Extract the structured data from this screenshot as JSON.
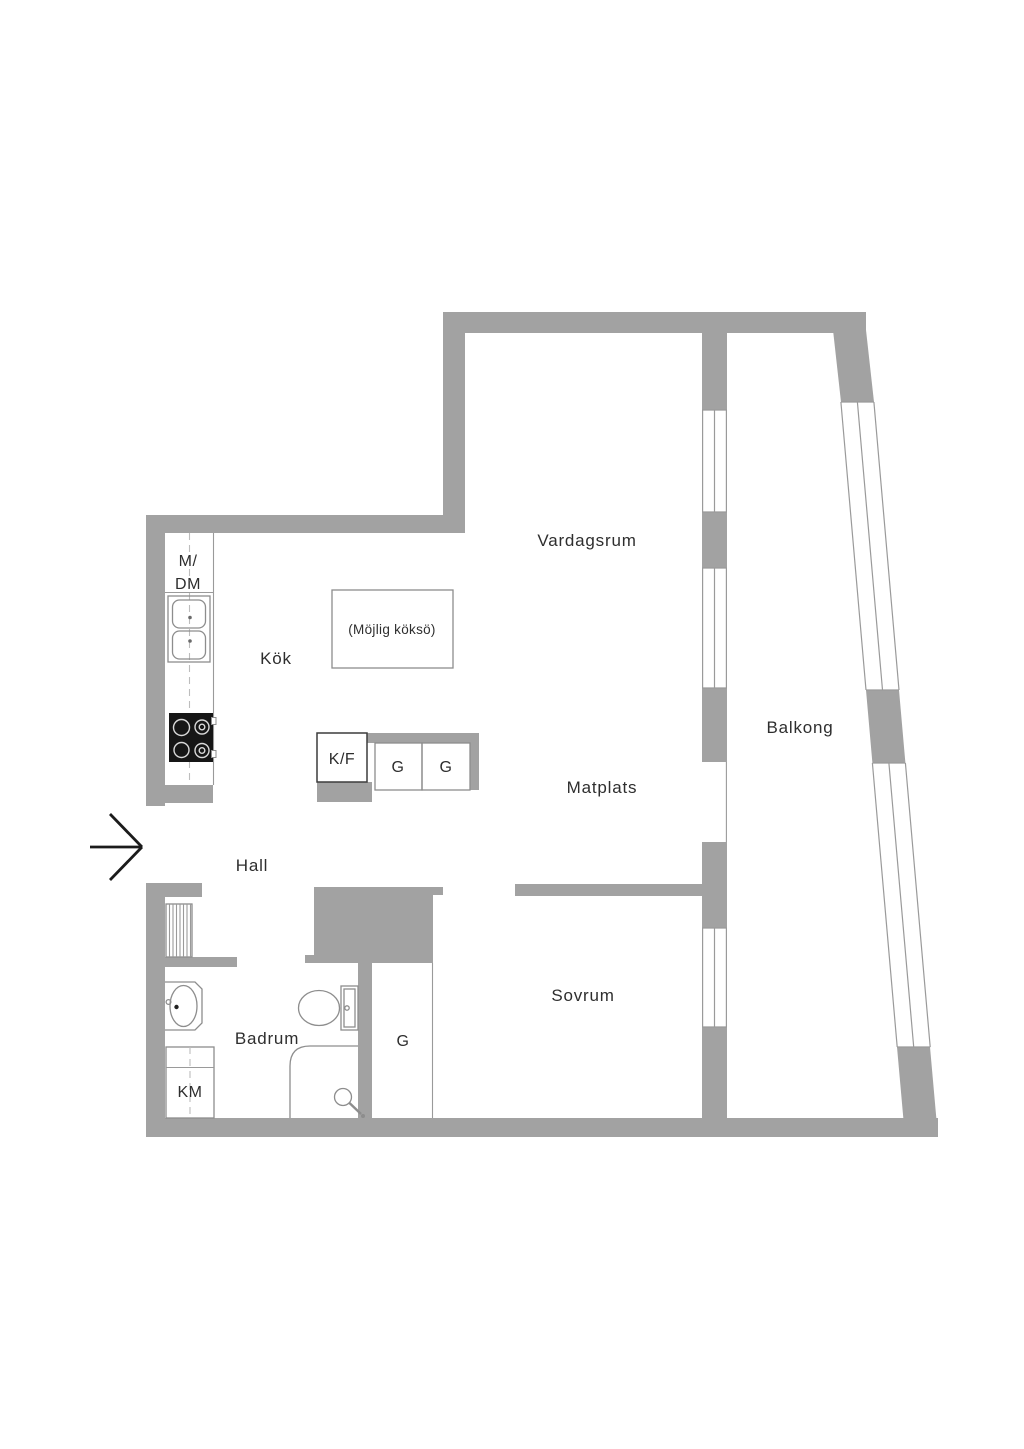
{
  "plan": {
    "rooms": {
      "vardagsrum": "Vardagsrum",
      "balkong": "Balkong",
      "kok": "Kök",
      "matplats": "Matplats",
      "hall": "Hall",
      "badrum": "Badrum",
      "sovrum": "Sovrum"
    },
    "appliances": {
      "m_dm_line1": "M/",
      "m_dm_line2": "DM",
      "kf": "K/F",
      "g1": "G",
      "g2": "G",
      "g_closet": "G",
      "km": "KM",
      "island_note": "(Möjlig köksö)"
    },
    "colors": {
      "wall": "#a2a2a2",
      "winline": "#9a9a9a",
      "fixline": "#8d8d8d",
      "dashline": "#bdbdbd",
      "text": "#2e2e2e",
      "stove": "#161616",
      "arrow": "#1b1b1b"
    }
  }
}
